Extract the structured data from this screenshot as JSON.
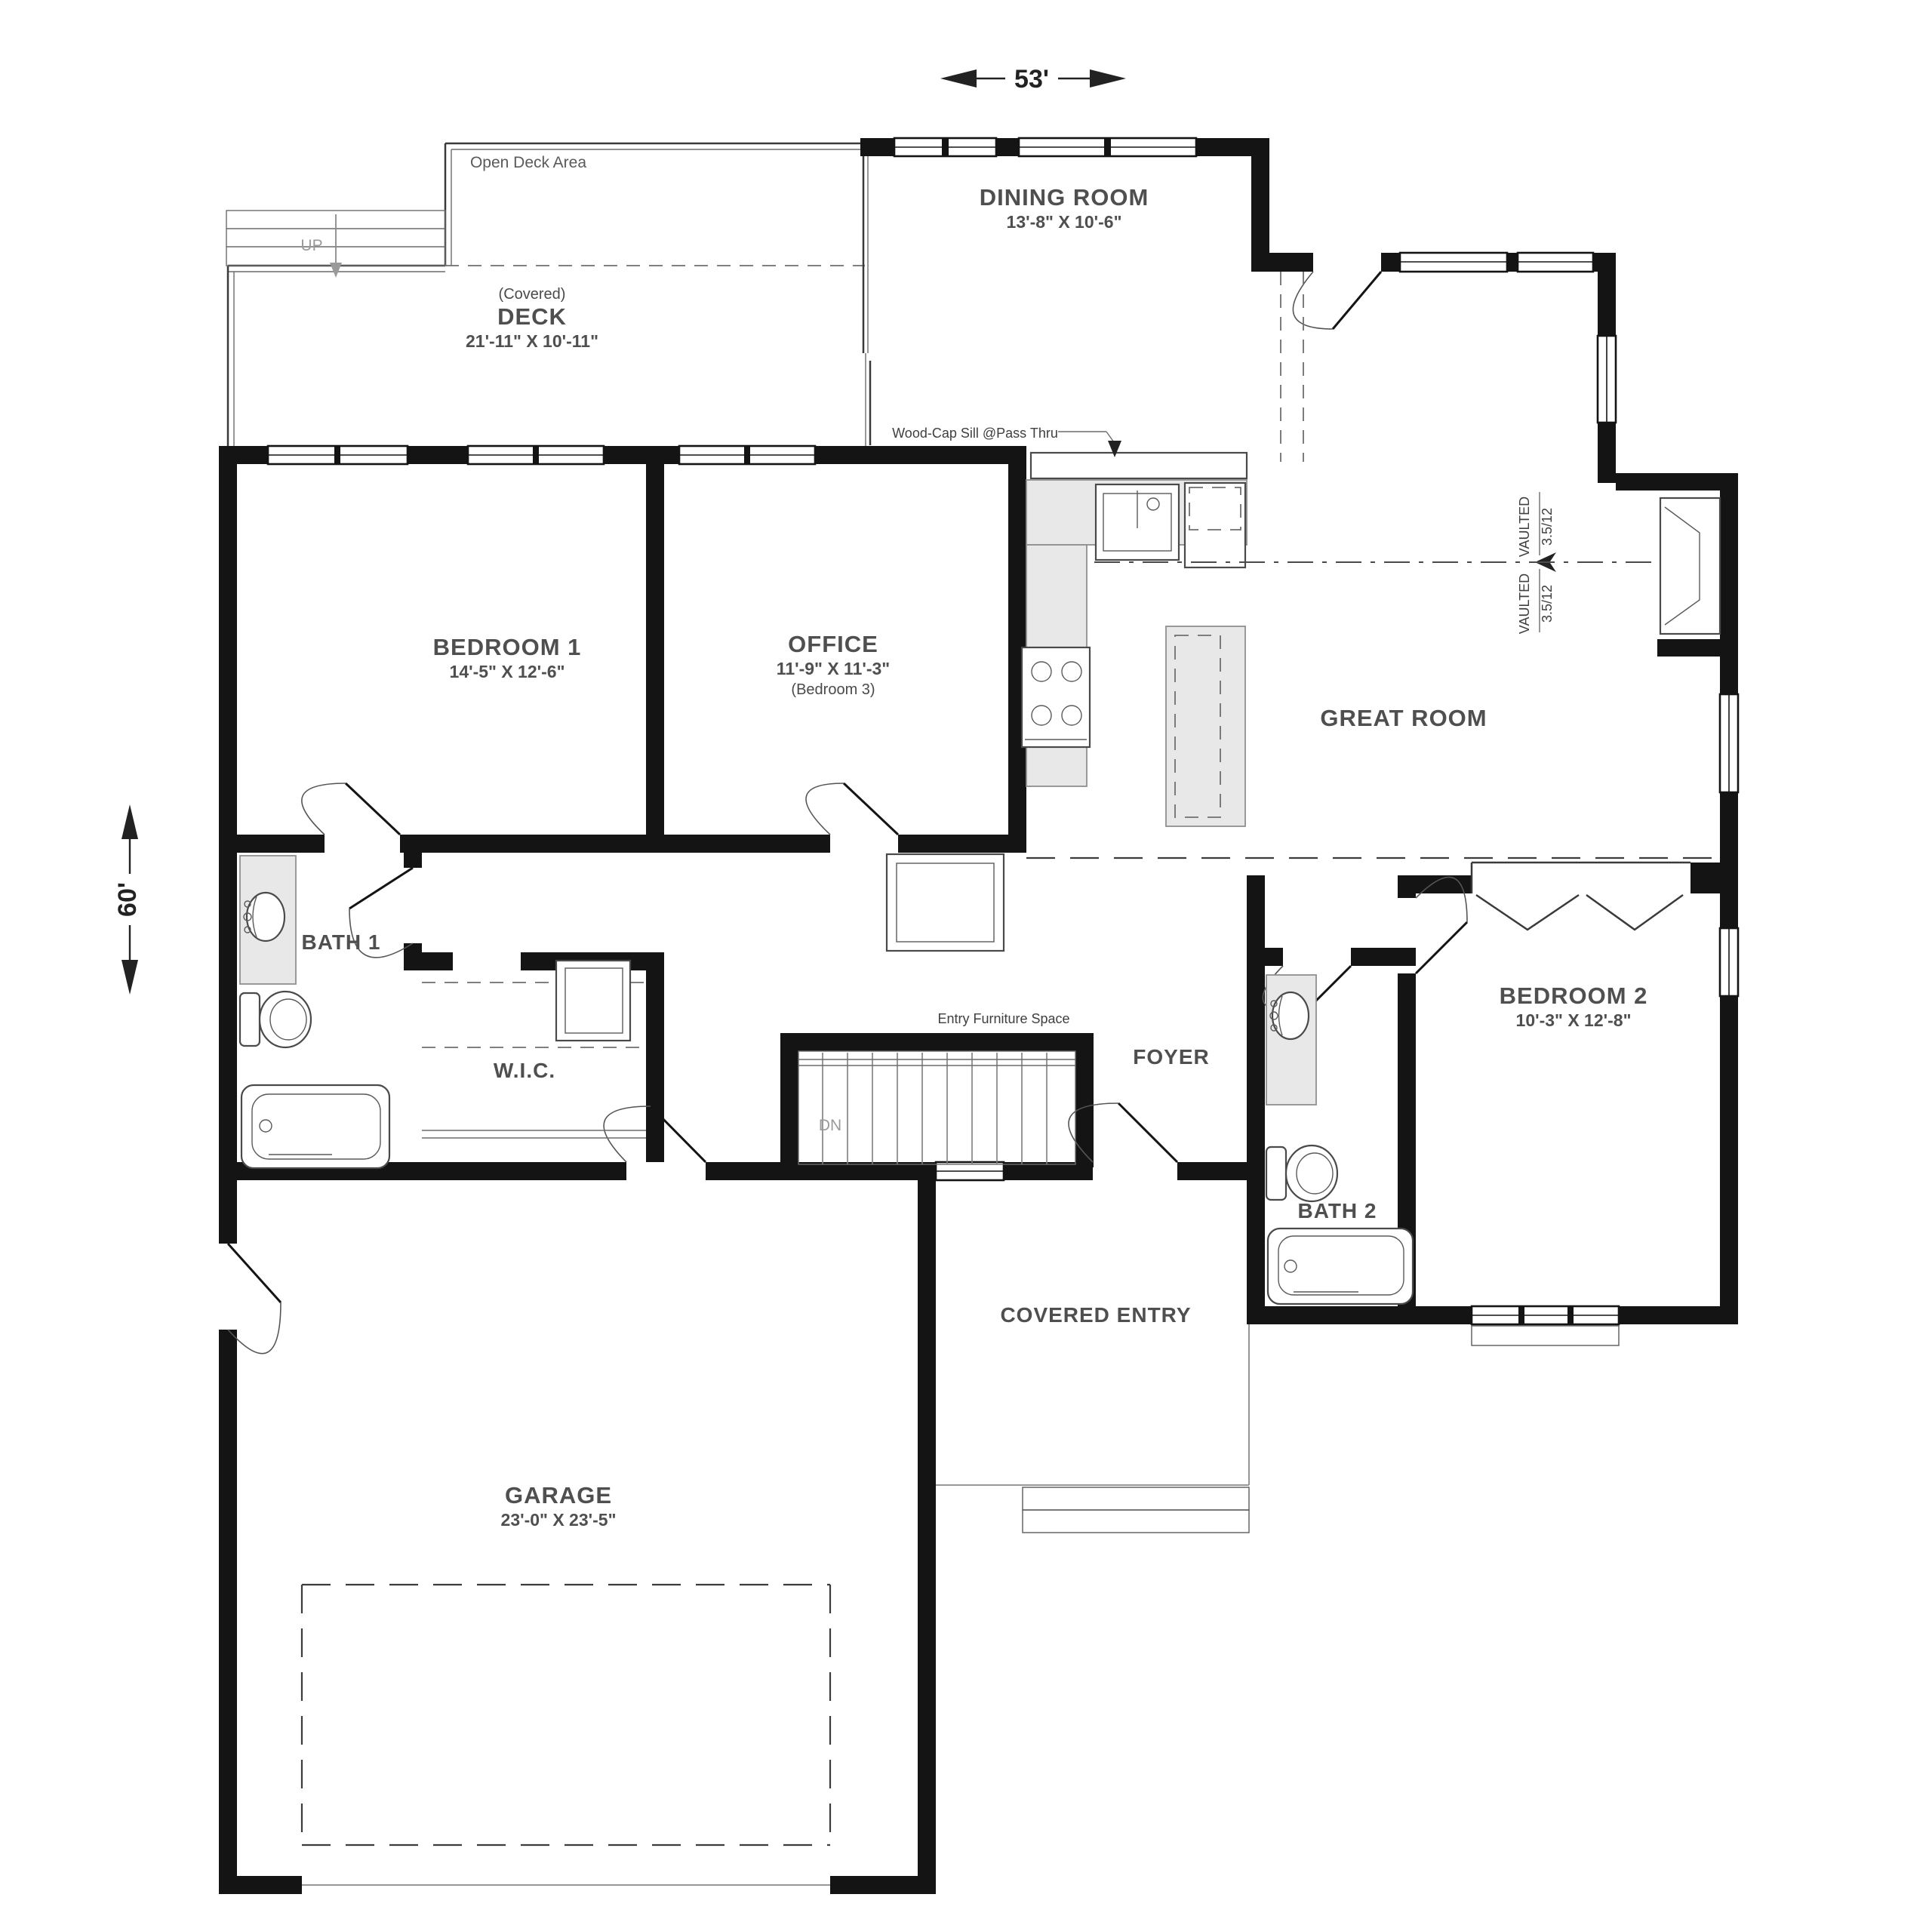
{
  "title": "Single level house floor plan",
  "dimensions": {
    "width_label": "53'",
    "height_label": "60'"
  },
  "rooms": {
    "dining": {
      "name": "DINING ROOM",
      "dims": "13'-8\" X 10'-6\""
    },
    "open_deck": {
      "label": "Open Deck Area"
    },
    "deck": {
      "covered": "(Covered)",
      "name": "DECK",
      "dims": "21'-11\" X 10'-11\""
    },
    "bedroom1": {
      "name": "BEDROOM 1",
      "dims": "14'-5\" X 12'-6\""
    },
    "office": {
      "name": "OFFICE",
      "dims": "11'-9\" X 11'-3\"",
      "alt": "(Bedroom 3)"
    },
    "great_room": {
      "name": "GREAT ROOM"
    },
    "bath1": {
      "name": "BATH 1"
    },
    "wic": {
      "name": "W.I.C."
    },
    "foyer": {
      "name": "FOYER"
    },
    "bedroom2": {
      "name": "BEDROOM 2",
      "dims": "10'-3\" X 12'-8\""
    },
    "bath2": {
      "name": "BATH 2"
    },
    "covered_entry": {
      "name": "COVERED ENTRY"
    },
    "garage": {
      "name": "GARAGE",
      "dims": "23'-0\" X 23'-5\""
    }
  },
  "annotations": {
    "up": "UP",
    "dn": "DN",
    "wood_cap_sill": "Wood-Cap Sill @Pass Thru",
    "entry_furniture": "Entry Furniture Space",
    "vaulted": "VAULTED",
    "pitch": "3.5/12"
  },
  "colors": {
    "wall": "#141414",
    "label": "#4f4f4f",
    "counter_fill": "#e8e8e8",
    "light_line": "#8a8a8a"
  }
}
